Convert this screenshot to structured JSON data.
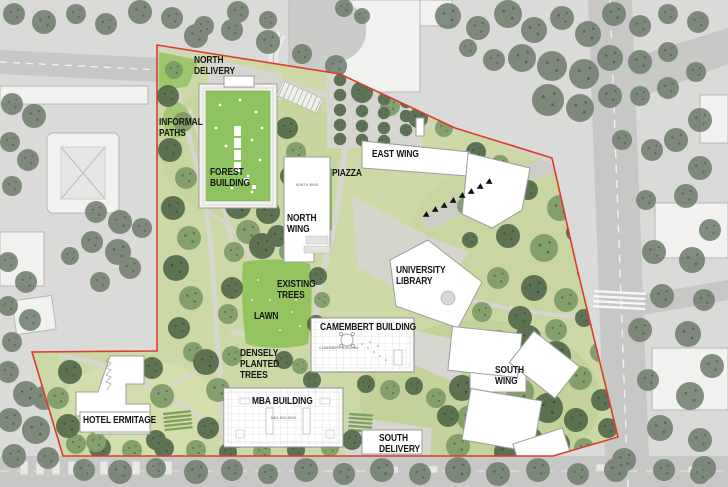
{
  "map": {
    "labels": {
      "north_delivery": "NORTH\nDELIVERY",
      "informal_paths": "INFORMAL\nPATHS",
      "forest_building": "FOREST\nBUILDING",
      "east_wing": "EAST WING",
      "piazza": "PIAZZA",
      "north_wing": "NORTH\nWING",
      "university_library": "UNIVERSITY\nLIBRARY",
      "existing_trees": "EXISTING\nTREES",
      "lawn": "LAWN",
      "camembert_building": "CAMEMBERT BUILDING",
      "densely_planted_trees": "DENSELY\nPLANTED\nTREES",
      "south_wing": "SOUTH\nWING",
      "hotel_ermitage": "HOTEL ERMITAGE",
      "mba_building": "MBA BUILDING",
      "south_delivery": "SOUTH\nDELIVERY"
    },
    "roof_captions": {
      "north_wing": "NORTH WING",
      "camembert": "CAMEMBERT BUILDING",
      "mba": "MBA BUILDING"
    },
    "colors": {
      "site_boundary": "#e03a2c",
      "lawn_light": "#ccd8a6",
      "lawn_bright": "#94c35f",
      "tree_medium": "#7c9a67",
      "tree_dark": "#50684a",
      "tree_gray": "#6e7c6c",
      "path_gray": "#d6d5cf",
      "building_fill": "#ffffff",
      "building_stroke": "#9d9d9b",
      "surround_gray": "#dadad8",
      "road_gray": "#c7c7c5",
      "label_color": "#141414"
    }
  }
}
